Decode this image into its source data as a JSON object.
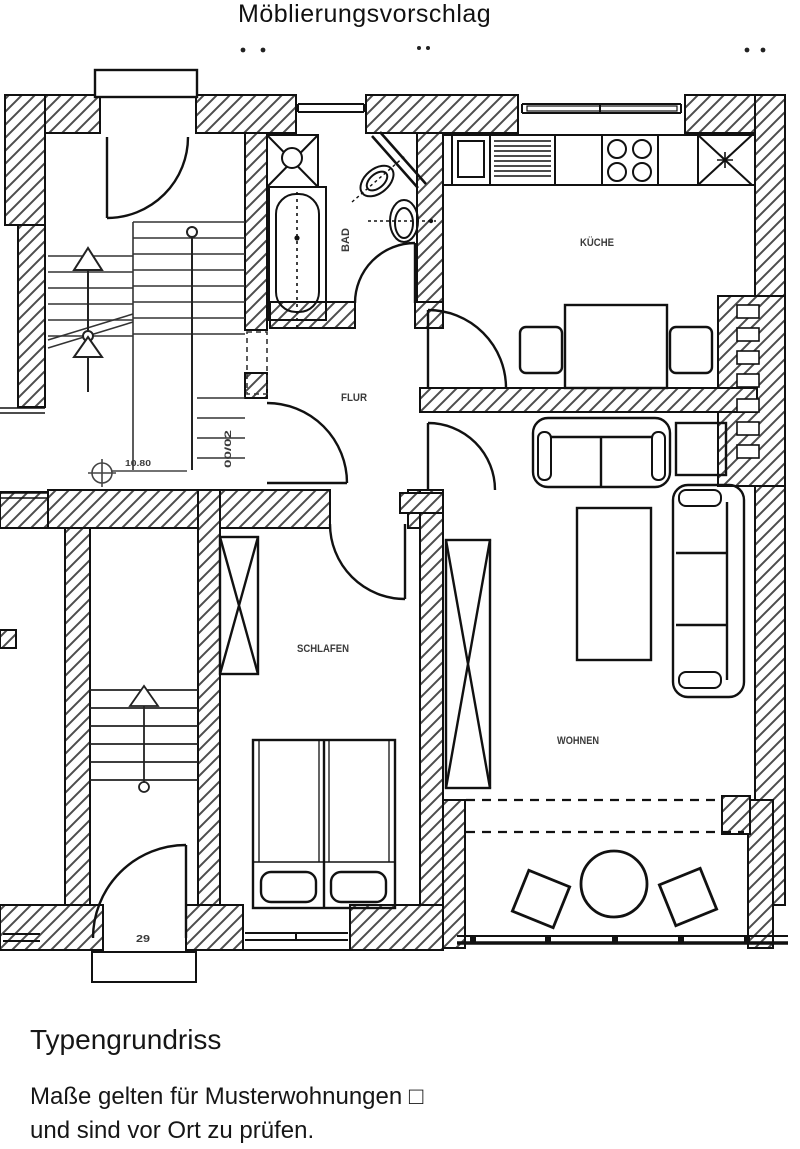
{
  "page": {
    "title": "Möblierungsvorschlag"
  },
  "plan": {
    "room_labels": {
      "kitchen": "KÜCHE",
      "bath": "BAD",
      "hall": "FLUR",
      "bedroom": "SCHLAFEN",
      "living": "WOHNEN"
    },
    "annotations": {
      "level_mark": "10.80",
      "unit_number": "00/02",
      "house_number": "29"
    }
  },
  "footer": {
    "heading": "Typengrundriss",
    "note_line1": "Maße gelten für Musterwohnungen □",
    "note_line2": "und sind vor Ort zu prüfen."
  },
  "colors": {
    "wall_line": "#111111",
    "hatch_line": "#4d4d4d",
    "label_text": "#3a3a3a"
  }
}
